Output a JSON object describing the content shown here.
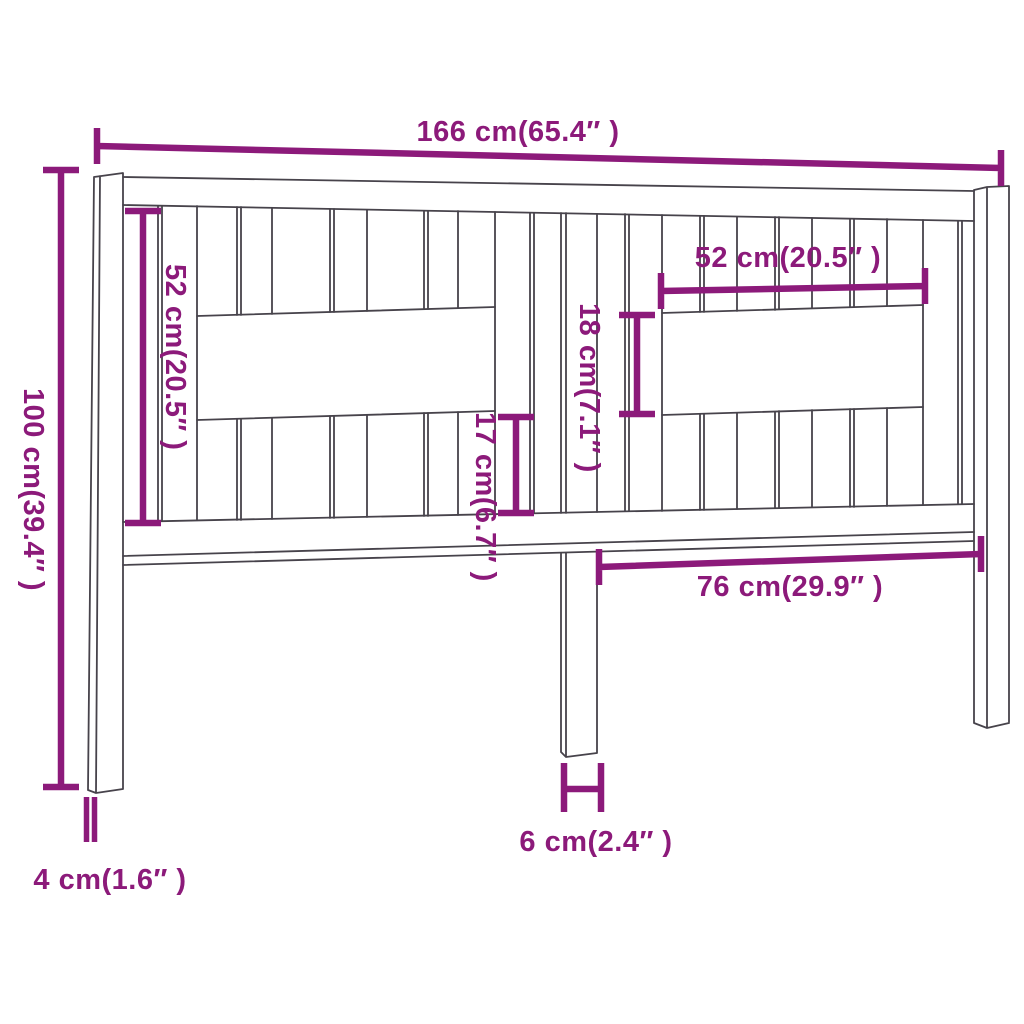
{
  "diagram": {
    "subject": "headboard-dimension-drawing",
    "colors": {
      "dimension": "#8C1A7A",
      "outline": "#47434B",
      "background": "#FFFFFF"
    },
    "dims": {
      "total_width": "166 cm(65.4″ )",
      "total_height": "100 cm(39.4″ )",
      "left_panel_height": "52 cm(20.5″ )",
      "right_opening_width": "52 cm(20.5″ )",
      "opening_height": "18 cm(7.1″ )",
      "lower_slat_height": "17 cm(6.7″ )",
      "leg_spacing": "76 cm(29.9″ )",
      "center_leg_width": "6 cm(2.4″ )",
      "side_leg_depth": "4 cm(1.6″ )"
    }
  }
}
